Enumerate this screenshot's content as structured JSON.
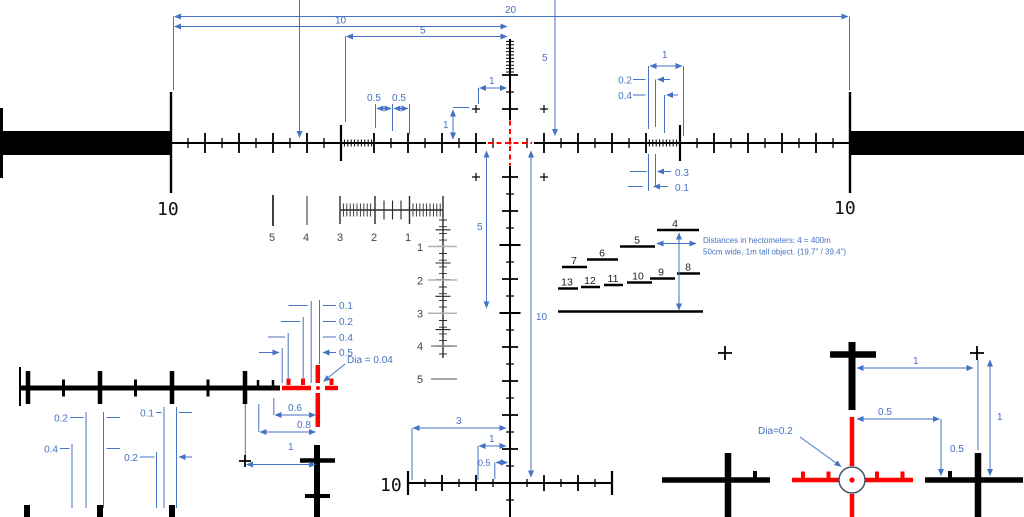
{
  "title": "Mil reticle dimension drawing",
  "colors": {
    "dimension_blue": "#4472C4",
    "reticle_red": "#FF0000",
    "reticle_black": "#000000",
    "ruler_gray": "#9a9a9a"
  },
  "labels": {
    "post_left": "10",
    "post_right": "10",
    "line_bottom": "10",
    "d20": "20",
    "d10": "10",
    "d5top": "5",
    "d05a": "0.5",
    "d05b": "0.5",
    "d5up": "5",
    "d1lv": "1",
    "d1lh": "1",
    "d1r": "1",
    "d02r": "0.2",
    "d04r": "0.4",
    "d03r": "0.3",
    "d01r": "0.1",
    "d5dn": "5",
    "d10dn": "10",
    "d3b": "3",
    "d1b": "1",
    "d05b2": "0.5"
  },
  "ruler": {
    "h": [
      "5",
      "4",
      "3",
      "2",
      "1"
    ],
    "v": [
      "1",
      "2",
      "3",
      "4",
      "5"
    ]
  },
  "rangefinder": {
    "steps": [
      "4",
      "5",
      "6",
      "7",
      "8",
      "9",
      "10",
      "11",
      "12",
      "13"
    ],
    "note1": "Distances in hectometers: 4 = 400m",
    "note2": "50cm wide,  1m tall object. (19.7\" / 39.4\")"
  },
  "detail_left": {
    "dia": "Dia = 0.04",
    "offsets": [
      "0.1",
      "0.2",
      "0.4",
      "0.5"
    ],
    "d06": "0.6",
    "d08": "0.8",
    "d1": "1",
    "low": [
      "0.2",
      "0.4",
      "0.1",
      "0.2"
    ]
  },
  "detail_right": {
    "dia": "Dia=0.2",
    "dtop1": "1",
    "dright1": "1",
    "d05h": "0.5",
    "d05v": "0.5"
  }
}
